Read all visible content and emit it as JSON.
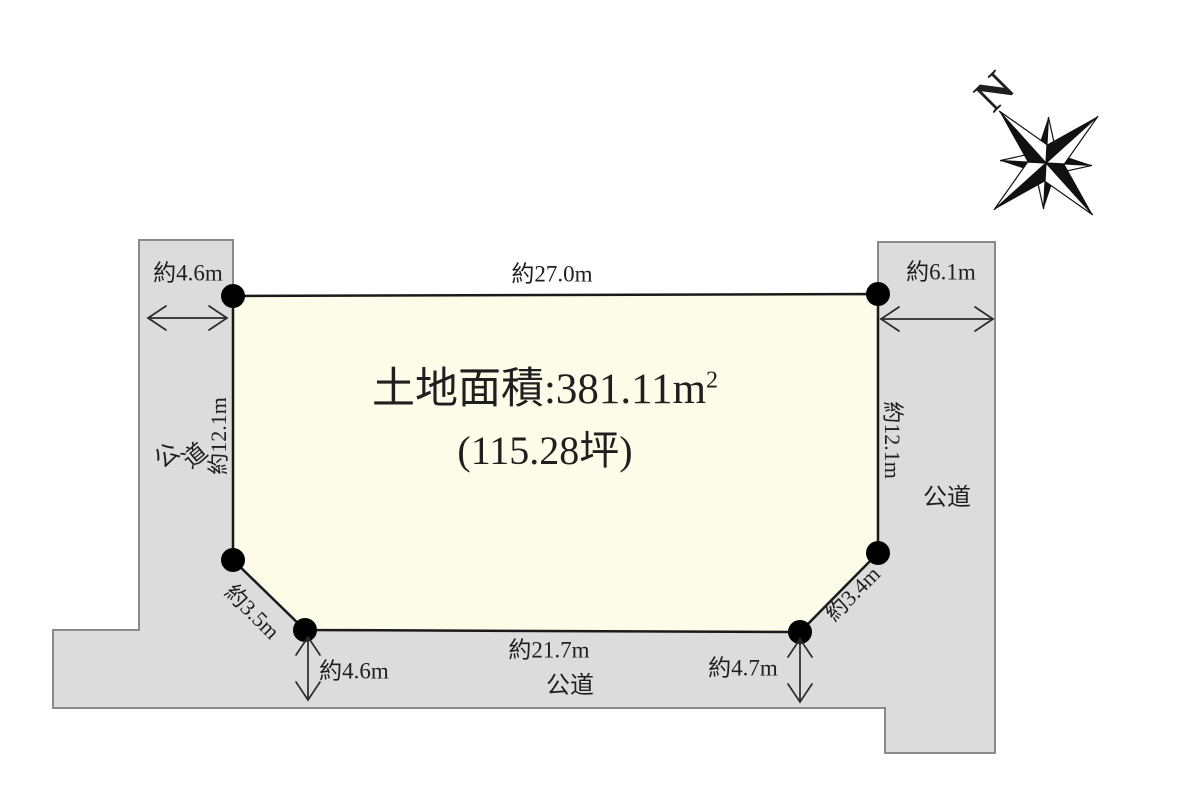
{
  "figure": {
    "compass_label": "N",
    "area_title": {
      "line1_base": "土地面積:381.11m",
      "line1_sup": "2",
      "line2": "(115.28坪)"
    },
    "dimensions": {
      "north_edge": "約27.0m",
      "west_road_width": "約4.6m",
      "east_road_width": "約6.1m",
      "west_edge": "約12.1m",
      "east_edge": "約12.1m",
      "southwest_corner_cut": "約3.5m",
      "southeast_corner_cut": "約3.4m",
      "south_edge": "約21.7m",
      "south_road_width_west": "約4.6m",
      "south_road_width_east": "約4.7m"
    },
    "roads": {
      "west": "公道",
      "east": "公道",
      "south": "公道"
    }
  },
  "colors": {
    "road_fill": "#dcdcdc",
    "road_stroke": "#8a8a8a",
    "plot_fill": "#fdfce8",
    "plot_stroke": "#1a1a1a",
    "ink": "#1f1f1f"
  }
}
